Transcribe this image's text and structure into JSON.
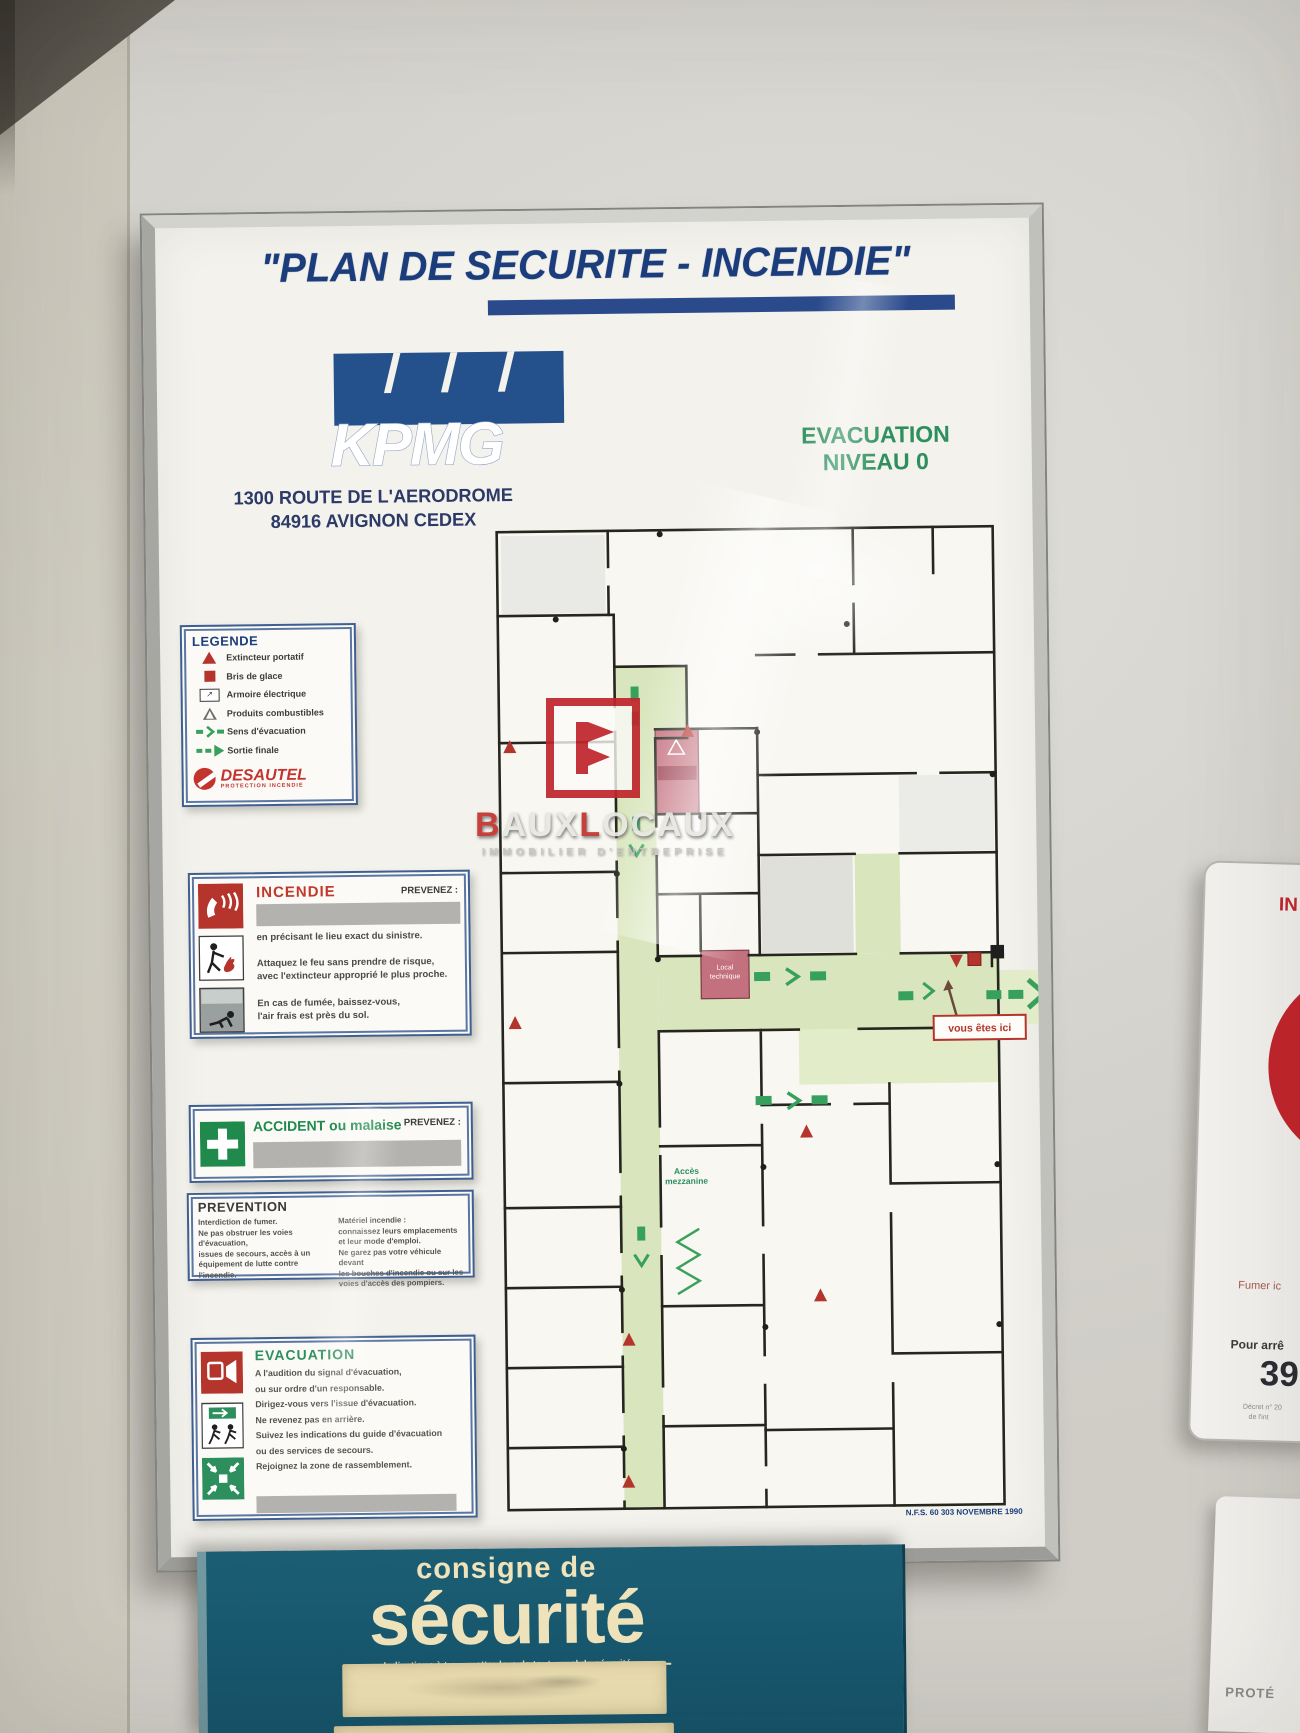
{
  "board": {
    "title": "\"PLAN DE SECURITE - INCENDIE\"",
    "kpmg": {
      "name": "KPMG",
      "address1": "1300 ROUTE DE L'AERODROME",
      "address2": "84916 AVIGNON CEDEX"
    },
    "level": {
      "line1": "EVACUATION",
      "line2": "NIVEAU 0"
    },
    "legend": {
      "title": "LEGENDE",
      "items": [
        {
          "label": "Extincteur portatif"
        },
        {
          "label": "Bris de glace"
        },
        {
          "label": "Armoire électrique"
        },
        {
          "label": "Produits combustibles"
        },
        {
          "label": "Sens d'évacuation"
        },
        {
          "label": "Sortie finale"
        }
      ],
      "brand": "DESAUTEL",
      "brand_sub": "PROTECTION INCENDIE",
      "cabinet_glyph": "↗"
    },
    "incendie": {
      "title": "INCENDIE",
      "call": "PREVENEZ :",
      "line1": "en précisant le lieu exact du sinistre.",
      "line2a": "Attaquez le feu sans prendre de risque,",
      "line2b": "avec l'extincteur approprié le plus proche.",
      "line3a": "En cas de fumée, baissez-vous,",
      "line3b": "l'air frais est près du sol."
    },
    "accident": {
      "title": "ACCIDENT ou malaise",
      "call": "PREVENEZ :"
    },
    "prevention": {
      "title": "PREVENTION",
      "left": [
        "Interdiction de fumer.",
        "Ne pas obstruer les voies d'évacuation,",
        "issues de secours, accès à un",
        "équipement de lutte contre l'incendie."
      ],
      "right": [
        "Matériel incendie :",
        "connaissez leurs emplacements",
        "et leur mode d'emploi.",
        "Ne garez pas votre véhicule devant",
        "les bouches d'incendie ou sur les",
        "voies d'accès des pompiers."
      ]
    },
    "evacuation": {
      "title": "EVACUATION",
      "lines": [
        "A l'audition du signal d'évacuation,",
        "ou sur ordre d'un responsable.",
        "Dirigez-vous vers l'issue d'évacuation.",
        "Ne revenez pas en arrière.",
        "Suivez les indications du guide d'évacuation",
        "ou des services de secours.",
        "Rejoignez la zone de rassemblement."
      ]
    },
    "plan": {
      "you_are_here": "vous êtes ici",
      "access1": "Accès",
      "access2": "mezzanine",
      "local1": "Local",
      "local2": "technique",
      "norm": "N.F.S. 60 303 NOVEMBRE 1990"
    }
  },
  "watermark": {
    "b1": "B",
    "mid1": "AUX",
    "b2": "L",
    "mid2": "OCAUX",
    "tagline": "IMMOBILIER D'ENTREPRISE"
  },
  "consigne": {
    "line1": "consigne de",
    "line2": "sécurité",
    "caption": "Indications à transmettre lors de tout appel de sécurité"
  },
  "no_smoking": {
    "title": "IN",
    "line1": "Fumer ic",
    "line2": "Pour arrê",
    "number": "39",
    "small1": "Décret n° 20",
    "small2": "de l'int"
  },
  "panel_bottom_right": {
    "text": "PROTÉ"
  },
  "colors": {
    "board_blue": "#1c3d7c",
    "green": "#2e8f5e",
    "red": "#b5342c",
    "teal": "#17596d",
    "cream": "#eee2b8",
    "plan_green": "#d9e6bd"
  }
}
